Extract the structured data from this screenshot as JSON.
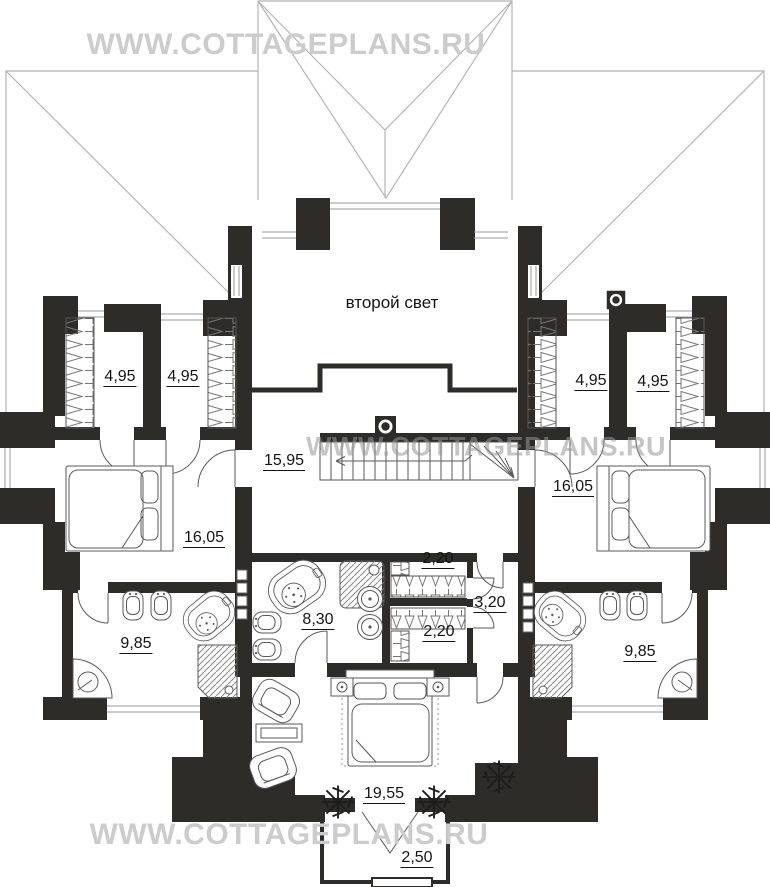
{
  "watermark": {
    "text": "WWW.COTTAGEPLANS.RU"
  },
  "plan": {
    "second_light_label": "второй свет",
    "labels": [
      {
        "id": "closet-left-a",
        "text": "4,95",
        "x": 120,
        "y": 377
      },
      {
        "id": "closet-left-b",
        "text": "4,95",
        "x": 183,
        "y": 377
      },
      {
        "id": "closet-right-a",
        "text": "4,95",
        "x": 591,
        "y": 381
      },
      {
        "id": "closet-right-b",
        "text": "4,95",
        "x": 653,
        "y": 382
      },
      {
        "id": "hall",
        "text": "15,95",
        "x": 284,
        "y": 461
      },
      {
        "id": "bedroom-left",
        "text": "16,05",
        "x": 204,
        "y": 538
      },
      {
        "id": "bedroom-right",
        "text": "16,05",
        "x": 573,
        "y": 487
      },
      {
        "id": "bathroom-left",
        "text": "9,85",
        "x": 136,
        "y": 644
      },
      {
        "id": "bathroom-center",
        "text": "8,30",
        "x": 318,
        "y": 620
      },
      {
        "id": "closet-center-top",
        "text": "2,20",
        "x": 438,
        "y": 559
      },
      {
        "id": "closet-center-bottom",
        "text": "2,20",
        "x": 439,
        "y": 632
      },
      {
        "id": "hall-small",
        "text": "3,20",
        "x": 490,
        "y": 603
      },
      {
        "id": "bathroom-right",
        "text": "9,85",
        "x": 640,
        "y": 652
      },
      {
        "id": "bedroom-center",
        "text": "19,55",
        "x": 384,
        "y": 794
      },
      {
        "id": "balcony",
        "text": "2,50",
        "x": 417,
        "y": 858
      }
    ],
    "colors": {
      "wall": "#2e2c29",
      "roof_line": "#b5b5b5",
      "furniture_line": "#5a5a5a",
      "label": "#141414",
      "watermark": "#cccccc",
      "watermark_mid": "#969696"
    }
  }
}
